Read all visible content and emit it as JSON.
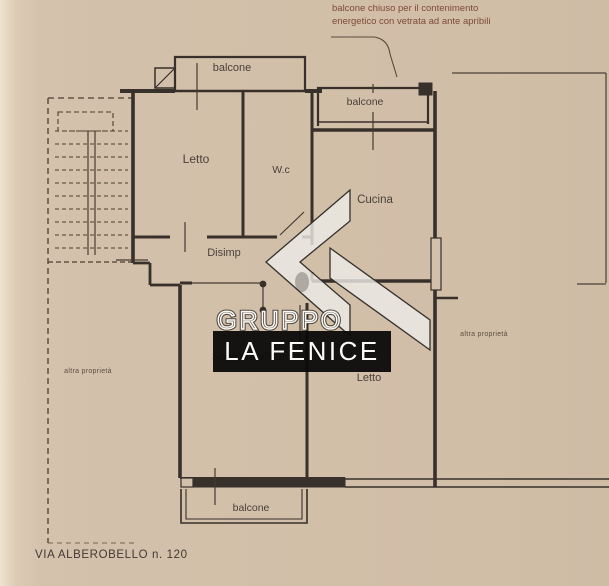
{
  "annotation": {
    "line1": "balcone chiuso per il contenimento",
    "line2": "energetico con  vetrata ad ante apribili"
  },
  "rooms": {
    "balcone_top_left": "balcone",
    "letto_1": "Letto",
    "wc": "W.c",
    "balcone_top_right": "balcone",
    "cucina": "Cucina",
    "disimp": "Disimp",
    "soggiorno": "Soggiorno/Pranzo",
    "letto_2": "Letto",
    "balcone_bottom": "balcone"
  },
  "neighbors": {
    "left": "altra proprietà",
    "right": "altra proprietà"
  },
  "watermark": {
    "group": "GRUPPO",
    "name": "LA FENICE"
  },
  "footer": {
    "address": "VIA ALBEROBELLO n. 120"
  },
  "colors": {
    "paper": "#d3c0aa",
    "ink": "#38302a",
    "annotation_ink": "#7c4a38",
    "watermark_band": "#0a0a0a",
    "watermark_text": "#ffffff"
  }
}
